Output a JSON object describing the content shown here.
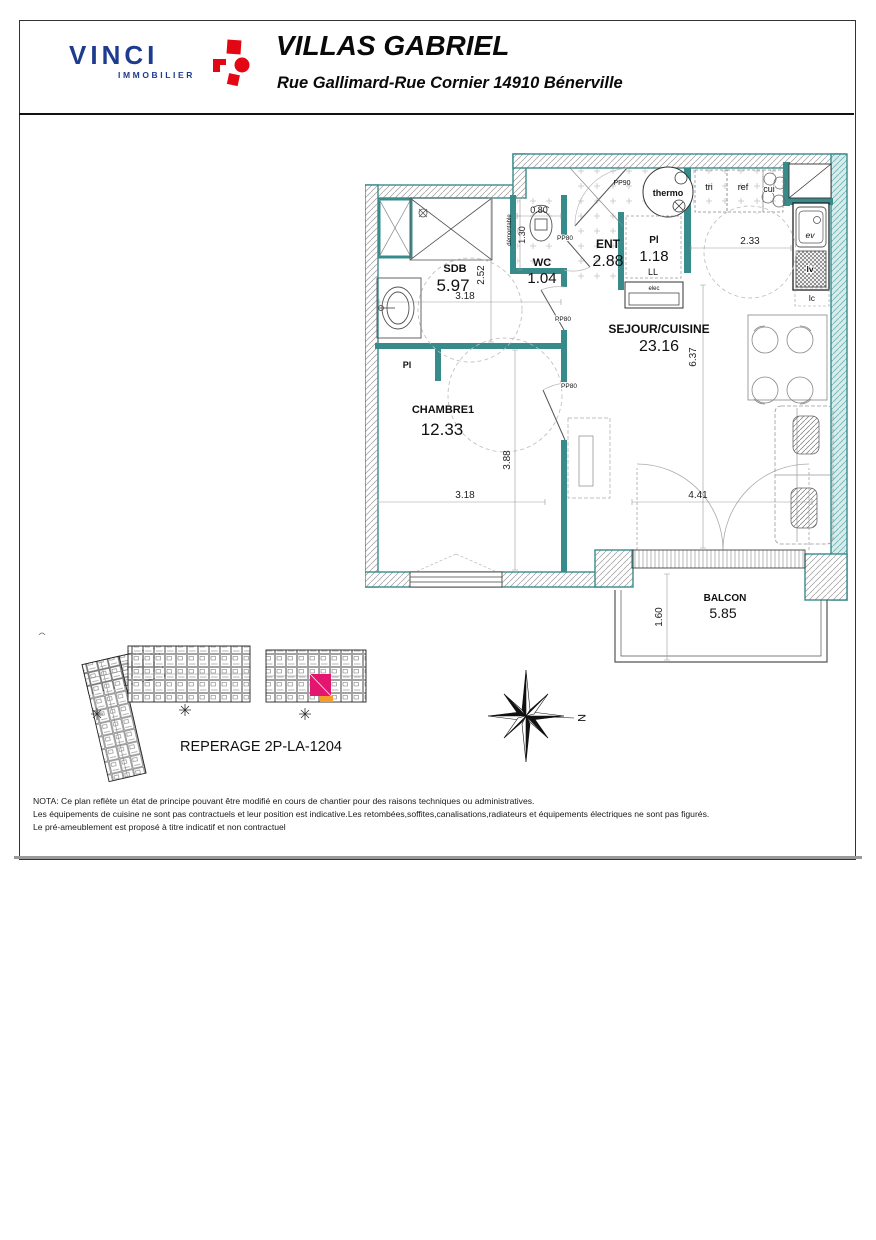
{
  "header": {
    "brand": "VINCI",
    "brand_sub": "IMMOBILIER",
    "title": "VILLAS GABRIEL",
    "subtitle": "Rue Gallimard-Rue Cornier 14910 Bénerville"
  },
  "plan": {
    "rooms": {
      "sdb": {
        "name": "SDB",
        "area": "5.97"
      },
      "wc": {
        "name": "WC",
        "area": "1.04"
      },
      "ent": {
        "name": "ENT",
        "area": "2.88"
      },
      "pl": {
        "name": "Pl",
        "area": "1.18"
      },
      "sejour": {
        "name": "SEJOUR/CUISINE",
        "area": "23.16"
      },
      "chambre": {
        "name": "CHAMBRE1",
        "area": "12.33"
      },
      "balcon": {
        "name": "BALCON",
        "area": "5.85"
      }
    },
    "dims": {
      "sdb_w": "3.18",
      "sdb_h": "2.52",
      "wc_w": "0.80",
      "wc_h": "1.30",
      "kitchen_w": "2.33",
      "sejour_h": "6.37",
      "chambre_h": "3.88",
      "chambre_w": "3.18",
      "sejour_w": "4.41",
      "balcon_d": "1.60"
    },
    "labels": {
      "pp90": "PP90",
      "pp80": "PP80",
      "demontable": "démontable",
      "thermo": "thermo",
      "tri": "tri",
      "ref": "ref",
      "cui": "cui",
      "ev": "ev",
      "lv": "lv",
      "lc": "lc",
      "ll": "LL",
      "elec": "elec",
      "pl": "Pl",
      "north": "N"
    }
  },
  "reperage": {
    "title": "REPERAGE 2P-LA-1204"
  },
  "nota": {
    "l1": "NOTA: Ce plan reflète un état de principe pouvant être modifié en cours de chantier pour des raisons techniques ou administratives.",
    "l2": "Les équipements de cuisine ne sont pas contractuels et leur position est indicative.Les retombées,soffites,canalisations,radiateurs et équipements électriques ne sont pas figurés.",
    "l3": "Le pré-ameublement est proposé à titre indicatif et non contractuel"
  },
  "colors": {
    "wall_teal": "#388b8b",
    "highlight_magenta": "#e4156f",
    "highlight_orange": "#f39c2c",
    "brand_blue": "#1d3c8f",
    "brand_red": "#e30613"
  }
}
